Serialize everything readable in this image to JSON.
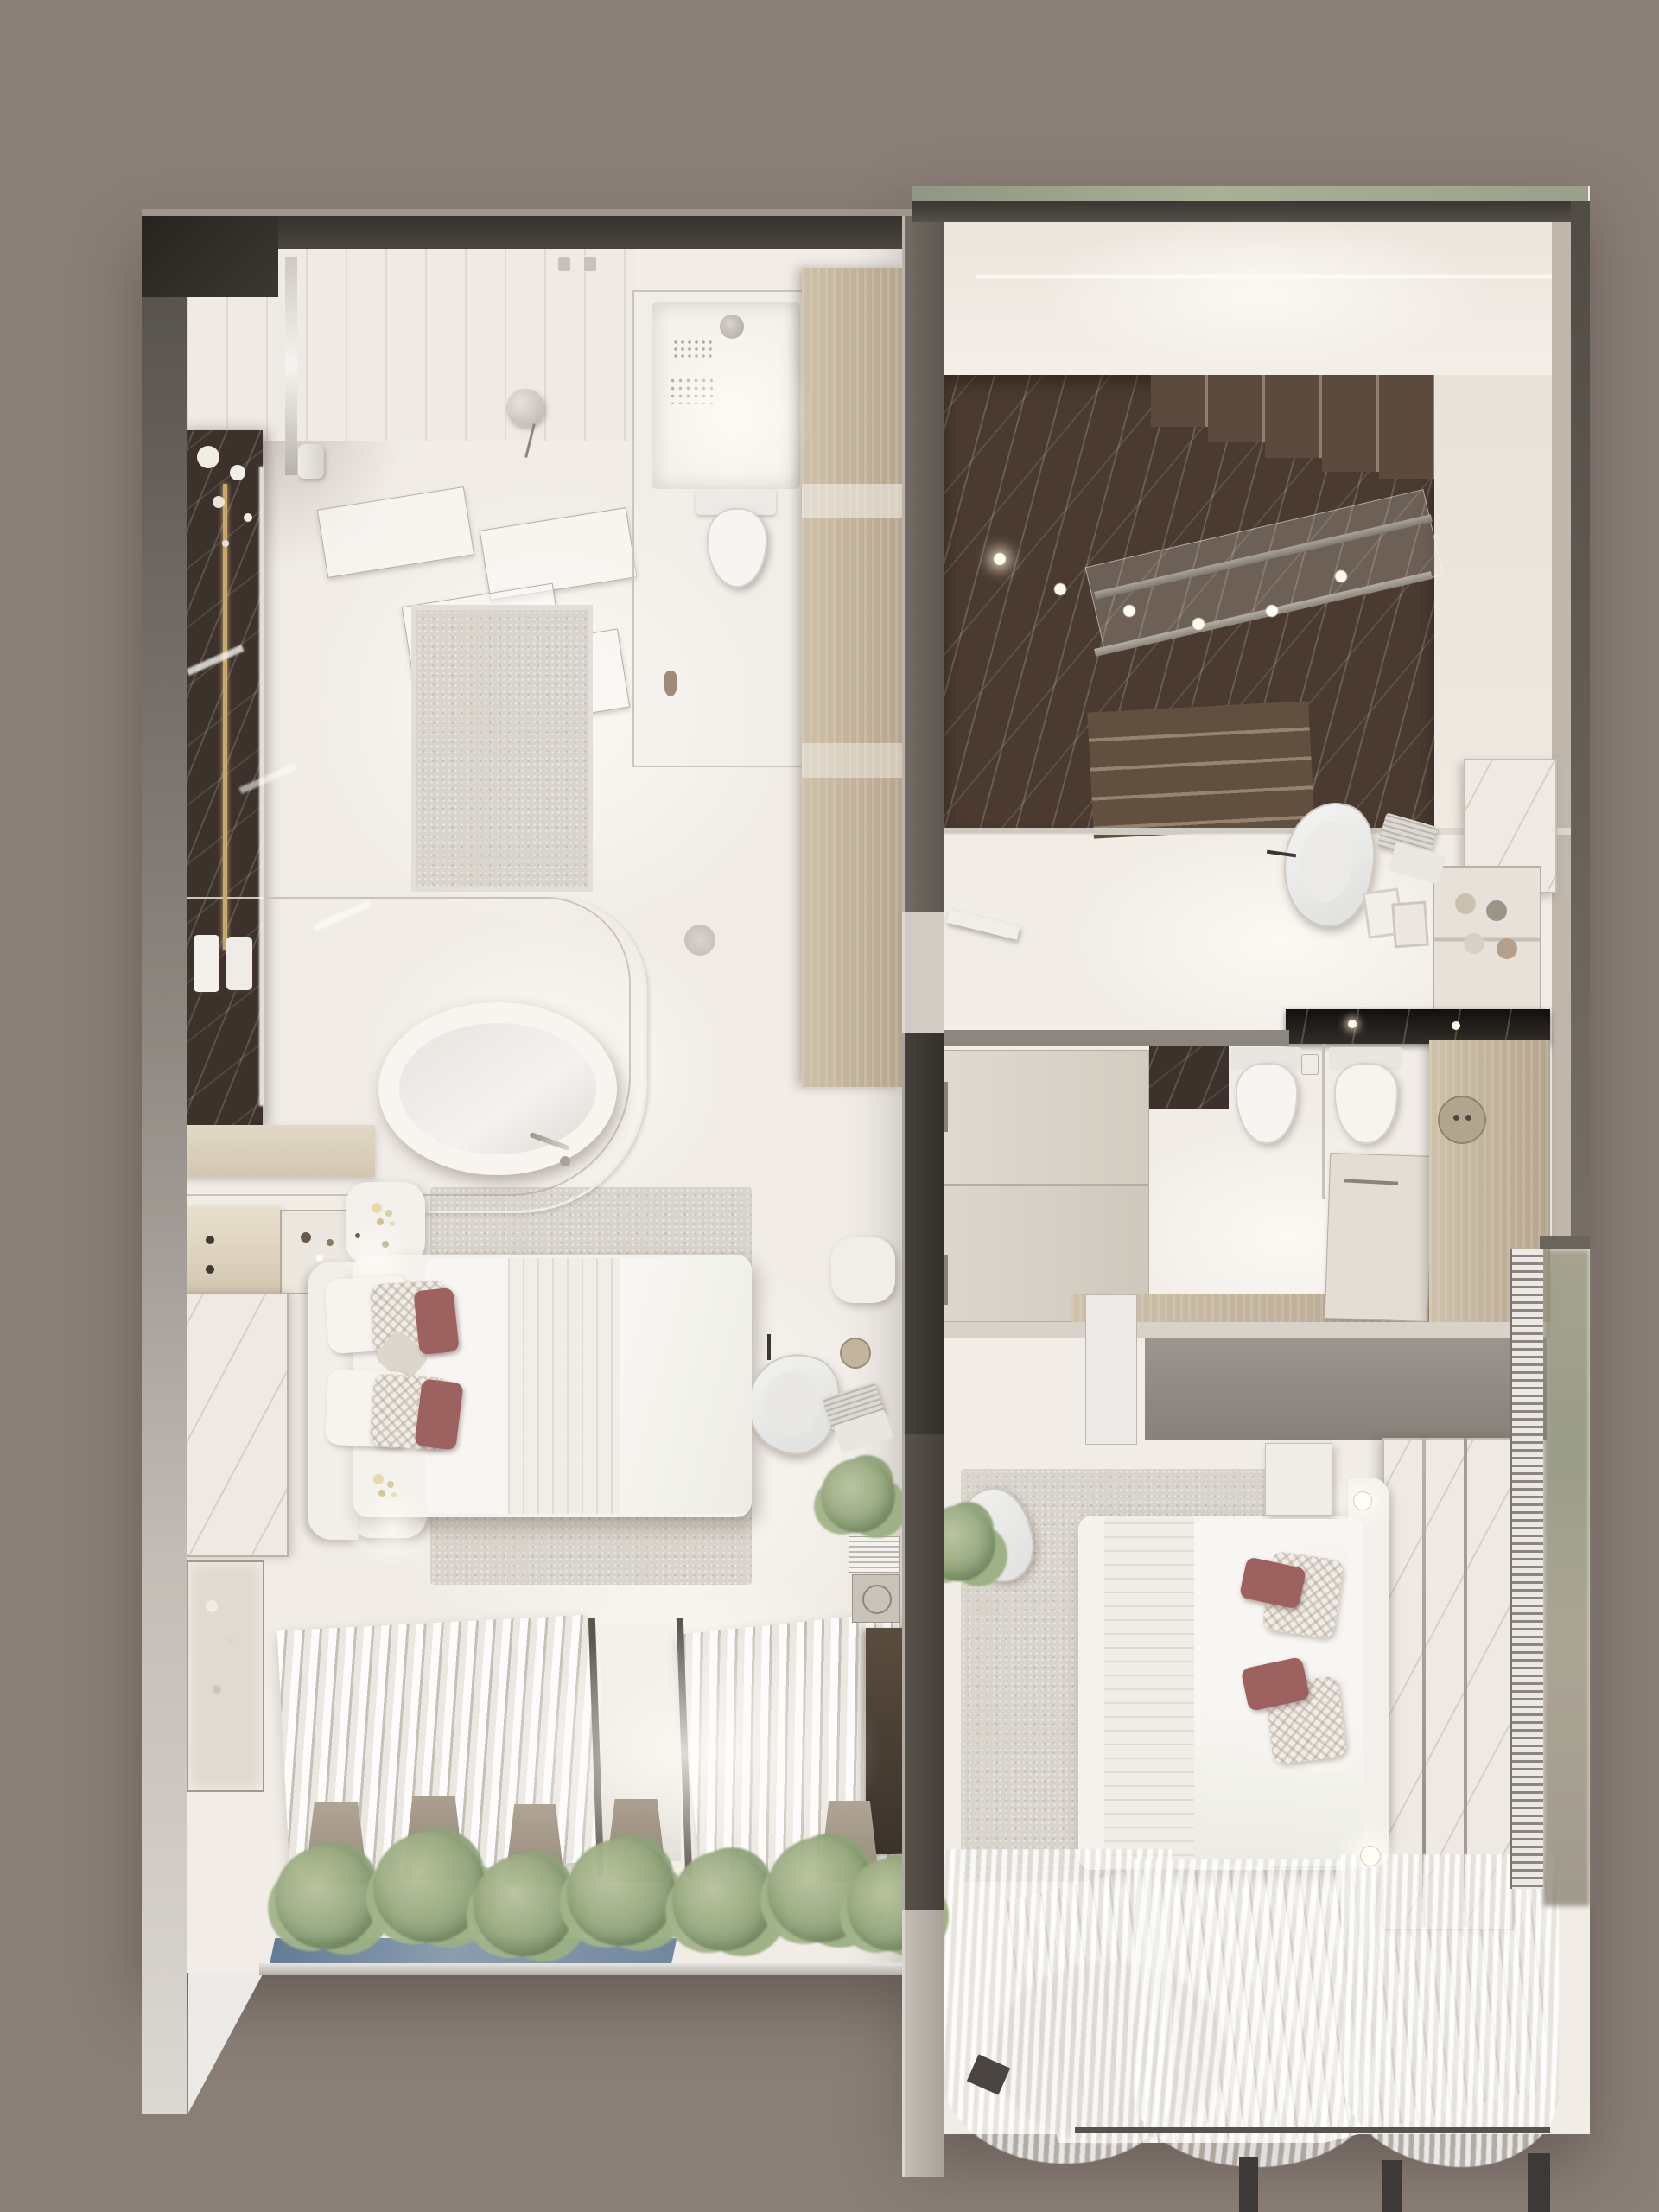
{
  "scene": {
    "type": "3d-floorplan-render",
    "view": "top-down overhead dollhouse render",
    "description": "Photorealistic top-down render of a duplex apartment: master suite with open bathroom on the left, dark-marble staircase and second bedroom suite on the right, louvered terraces with olive planting along the bottom.",
    "text_content": "none — image contains no readable text or UI labels"
  },
  "palette": {
    "background": "#8a7f77",
    "wall-dark": "#3e3935",
    "wall-mid": "#6b645d",
    "wall-light": "#cfc9c2",
    "floor": "#f1ece6",
    "marble-dark": "#3d322b",
    "marble-brown": "#4a3a30",
    "wood": "#cec0aa",
    "rug": "#d8d3cb",
    "linen-white": "#f5f2ed",
    "maroon": "#9d6260",
    "green": "#8fa379",
    "gold": "#c9a96a",
    "chrome": "#b9b2aa",
    "glass-blue": "#5f7a94",
    "counter-black": "#1d1a17",
    "curtain": "#f7f5f1"
  },
  "rooms": [
    {
      "name": "master-bathroom",
      "position": "top-left",
      "items": [
        "dark marble vanity wall with gold towel rail and magnolia flowers",
        "two white towels",
        "freestanding oval bathtub with chrome floor faucet",
        "curved double glass tub enclosure",
        "light gray rug",
        "glass shower room with white tray and rain head",
        "wall-hung toilet",
        "tall wood wardrobe column",
        "suspended translucent light panels",
        "ceiling slat band with disc sconce and towel roll"
      ]
    },
    {
      "name": "entry-stair-hall",
      "position": "top-right",
      "items": [
        "dark emperador marble staircase, two flights",
        "glass and steel railing",
        "recessed spotlights on marble",
        "white upper landing with LED cove line",
        "beige side wall pocket"
      ]
    },
    {
      "name": "study-nook",
      "position": "right-middle",
      "items": [
        "white organic lounge chair",
        "open laptop",
        "white marble desk slab",
        "shelf unit with yarn spools and vases",
        "leaning picture frames"
      ]
    },
    {
      "name": "second-bathroom",
      "position": "right-middle",
      "items": [
        "black marble vanity counter with lights",
        "wall-hung toilet and bidet",
        "glass partition",
        "dark marble art panel",
        "white storage cabinet",
        "wood panel with round control disc",
        "toilet paper holder"
      ]
    },
    {
      "name": "hall-wardrobe",
      "position": "center-right",
      "items": [
        "two sliding wardrobe doors with recessed handles",
        "open white door leaf"
      ]
    },
    {
      "name": "master-bedroom",
      "position": "left-middle",
      "items": [
        "upholstered bed with white duvet",
        "chevron pillows and two maroon accent pillows",
        "curved headboard",
        "two round nightstands with flowers and glowing lamps",
        "perfume dresser with glass display",
        "white marble art wall with LED edge",
        "glass display console",
        "large textured rug",
        "white lounge chair",
        "pouf",
        "round side disc table",
        "open laptop",
        "potted plant",
        "shelf with books and speaker",
        "dark wood sideboard"
      ]
    },
    {
      "name": "second-bedroom",
      "position": "bottom-right",
      "items": [
        "bed with white duvet and knit runner",
        "chevron and dusty-rose pillows",
        "white marble headboard wall with chrome strips",
        "two nightstands with glowing pendant bulbs",
        "textured rug",
        "white bedroom chair",
        "potted plant",
        "wood closet band",
        "gray bulkhead"
      ]
    },
    {
      "name": "terrace-louvers",
      "position": "bottom",
      "items": [
        "white louver pergola sections",
        "taupe planter pots",
        "row of olive trees",
        "blue glass strip",
        "sheer billowing curtains",
        "curtain rail",
        "dark window mullion posts",
        "vertical louver fin facade strip",
        "blurred exterior greenery"
      ]
    }
  ]
}
